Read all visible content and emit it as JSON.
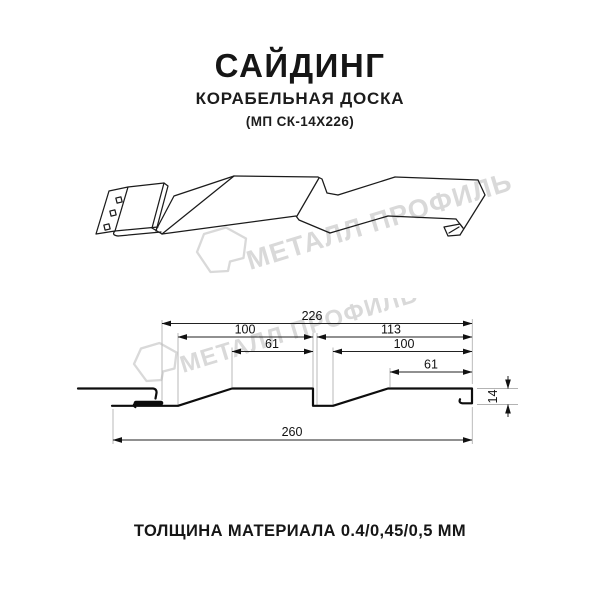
{
  "header": {
    "title": "САЙДИНГ",
    "subtitle": "КОРАБЕЛЬНАЯ ДОСКА",
    "code": "(МП СК-14Х226)"
  },
  "watermark": {
    "brand": "МЕТАЛЛ ПРОФИЛЬ",
    "color": "#d9d9d9"
  },
  "drawing": {
    "type": "siding-profile-cross-section",
    "dims": {
      "d226": "226",
      "d100_left": "100",
      "d113": "113",
      "d61_left": "61",
      "d100_right": "100",
      "d61_right": "61",
      "d14": "14",
      "d260": "260"
    }
  },
  "footer": {
    "thickness": "ТОЛЩИНА МАТЕРИАЛА 0.4/0,45/0,5 ММ"
  }
}
